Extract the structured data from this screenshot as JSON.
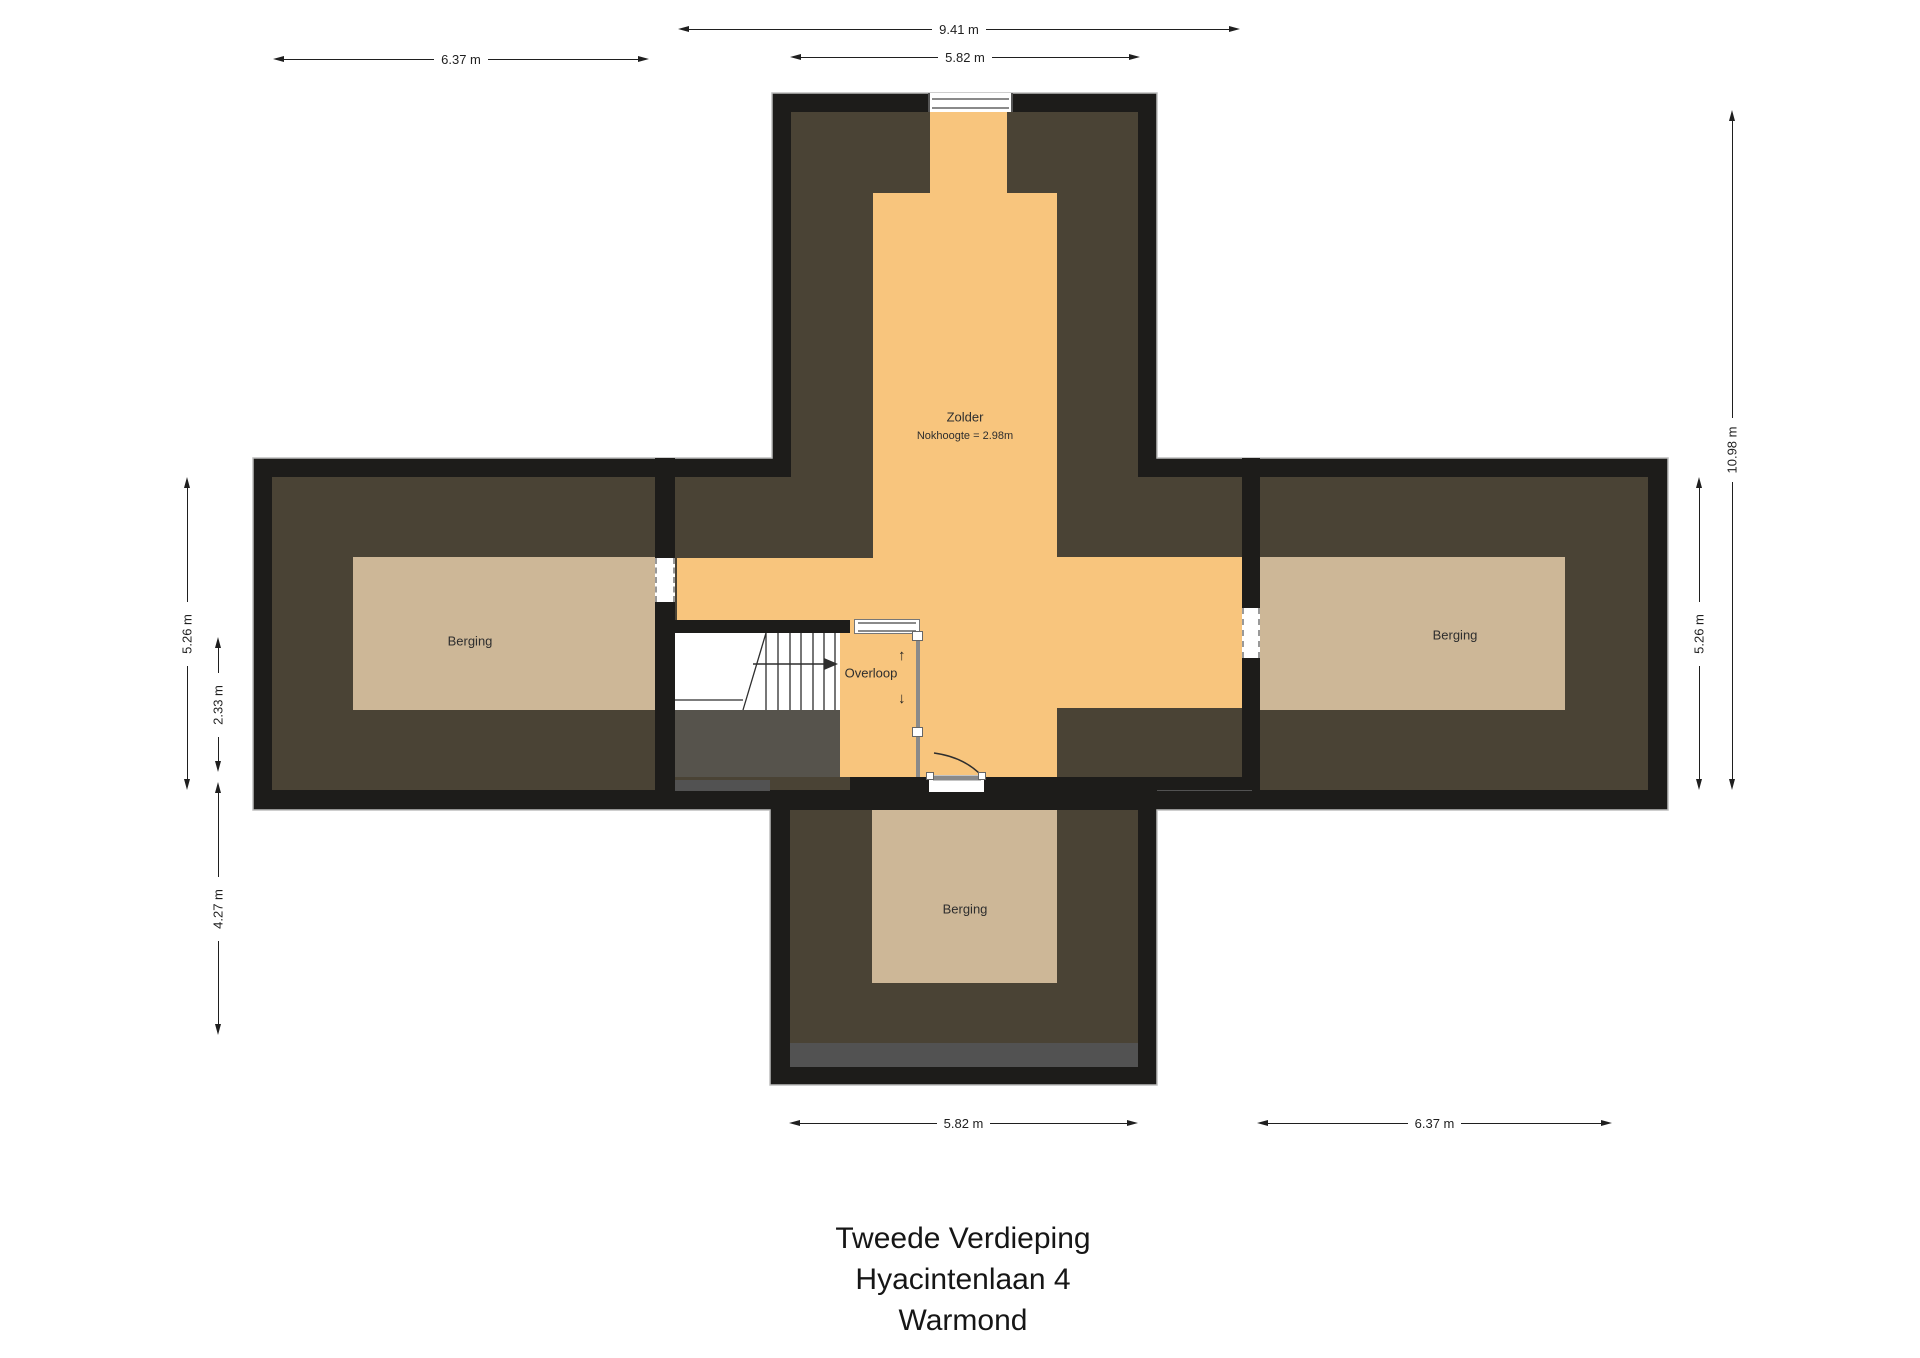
{
  "title": {
    "line1": "Tweede Verdieping",
    "line2": "Hyacintenlaan 4",
    "line3": "Warmond"
  },
  "rooms": {
    "zolder": {
      "label": "Zolder",
      "note": "Nokhoogte = 2.98m"
    },
    "overloop": {
      "label": "Overloop"
    },
    "berging_left": {
      "label": "Berging"
    },
    "berging_right": {
      "label": "Berging"
    },
    "berging_bottom": {
      "label": "Berging"
    }
  },
  "dimensions": {
    "top_outer": "9.41 m",
    "top_inner": "5.82 m",
    "top_left": "6.37 m",
    "left_height": "5.26 m",
    "left_inner": "2.33 m",
    "left_lower": "4.27 m",
    "right_total": "10.98 m",
    "right_height": "5.26 m",
    "bottom_center": "5.82 m",
    "bottom_right": "6.37 m"
  },
  "indicators": {
    "stair_up": "↑",
    "stair_down": "↓"
  },
  "colors": {
    "wall": "#1d1c1a",
    "outline": "#bdbdbd",
    "slope": "#4a4335",
    "tan": "#cdb797",
    "orange": "#f8c57d",
    "gray_strip": "#525252",
    "under_stairs": "#56534c",
    "window_frame": "#8a8a8a",
    "dim_color": "#1f1f1f",
    "label_color": "#2e2e2e",
    "title_color": "#161616",
    "door_line": "#8a8a8a"
  }
}
